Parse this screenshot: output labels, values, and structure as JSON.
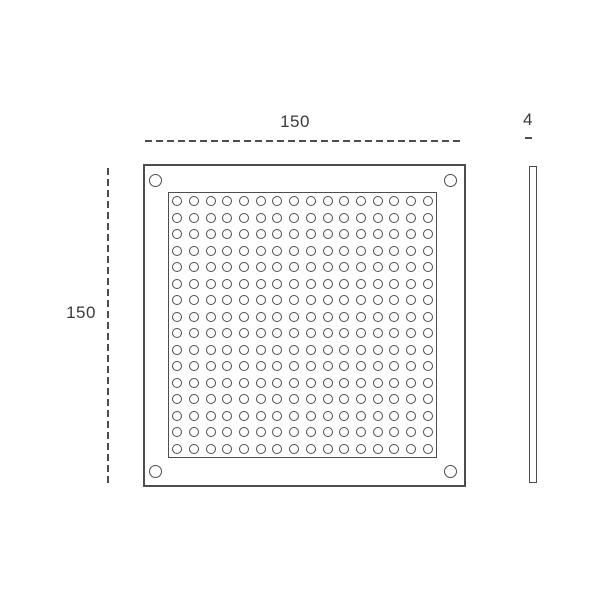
{
  "drawing": {
    "background": "#ffffff",
    "line_color": "#4d4d4d",
    "text_color": "#3a3a3a"
  },
  "dimensions": {
    "width": {
      "label": "150"
    },
    "height": {
      "label": "150"
    },
    "thickness": {
      "label": "4"
    }
  },
  "front_view": {
    "perforation_grid": {
      "rows": 16,
      "cols": 16,
      "hole_count": 256
    },
    "corner_holes": {
      "count": 4
    }
  }
}
